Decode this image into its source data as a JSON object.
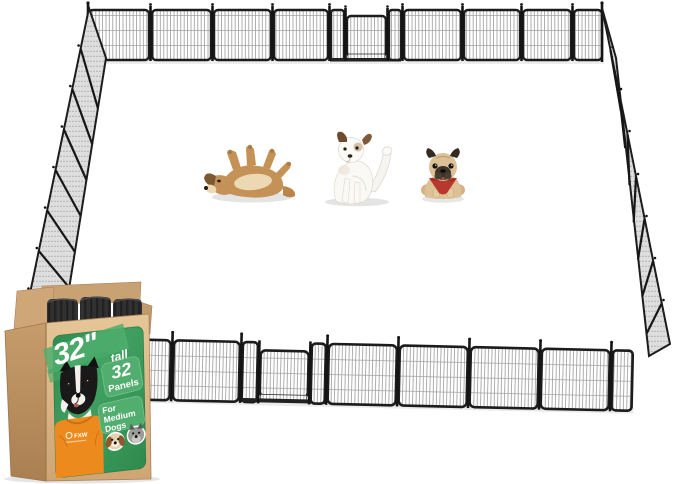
{
  "product": {
    "brand": "FXW",
    "label": {
      "size_number": "32\"",
      "size_word": "tall",
      "panels_number": "32",
      "panels_word": "Panels",
      "for_word": "For",
      "medium_word": "Medium",
      "dogs_word": "Dogs"
    }
  },
  "colors": {
    "label-green": "#3f9e5e",
    "label-green-dark": "#2f8a4e",
    "badge-green": "#52ae6e",
    "cardboard": "#d8b488",
    "cardboard-dark": "#bf9565",
    "shirt-orange": "#ec8a1e",
    "bandana-red": "#b8372e",
    "fence-frame": "#1c1c1c"
  },
  "scene": {
    "dogs": [
      {
        "id": "rolling-dog"
      },
      {
        "id": "scratching-dog"
      },
      {
        "id": "pug-dog"
      }
    ]
  }
}
